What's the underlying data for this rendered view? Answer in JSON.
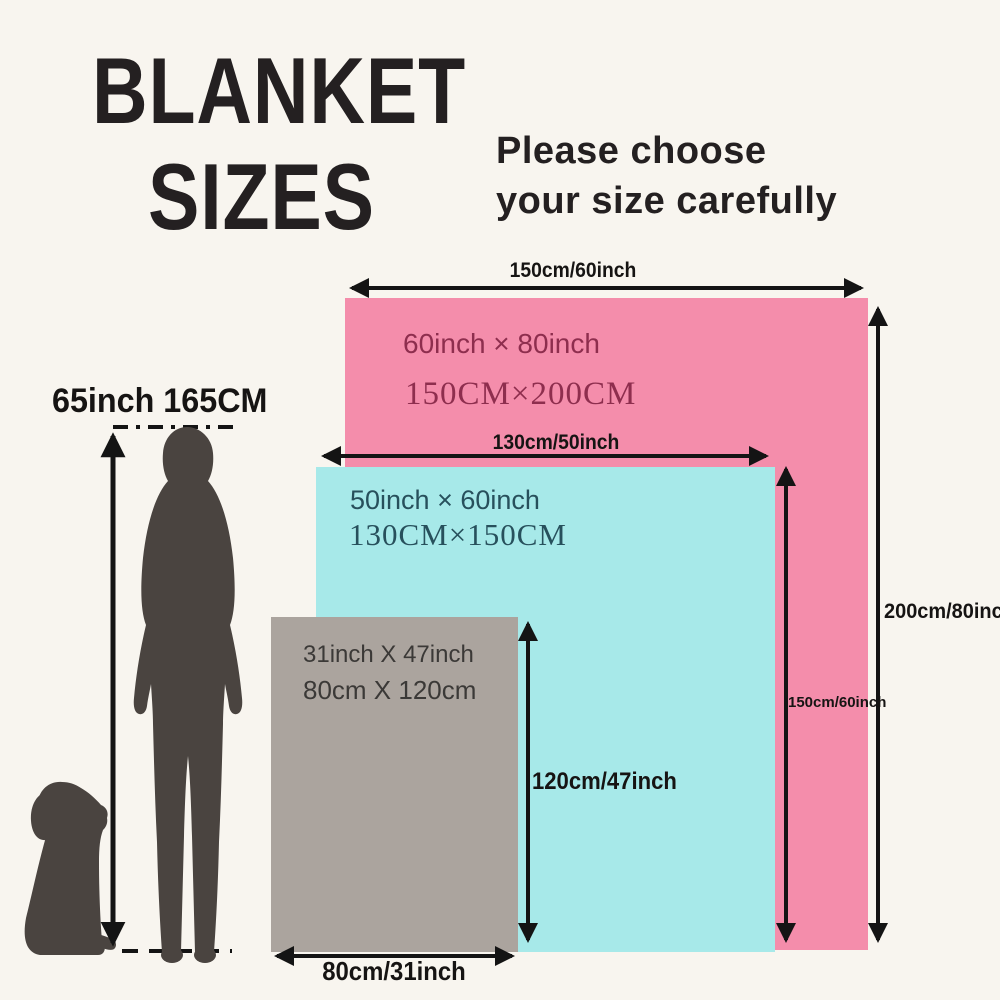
{
  "page": {
    "background": "#f8f5ef",
    "ink_color": "#141414"
  },
  "title": {
    "line1": "BLANKET",
    "line2": "SIZES"
  },
  "subtitle": {
    "line1": "Please choose",
    "line2": "your size carefully"
  },
  "person": {
    "height_label": "65inch 165CM",
    "silhouette_color": "#4a4440"
  },
  "blankets": {
    "large": {
      "fill": "#f48dab",
      "text_color": "#8e2e4e",
      "size_inch": "60inch × 80inch",
      "size_cm": "150CM×200CM",
      "width_label": "150cm/60inch",
      "height_label": "200cm/80inch"
    },
    "medium": {
      "fill": "#a7e9e9",
      "text_color": "#27505c",
      "size_inch": "50inch × 60inch",
      "size_cm": "130CM×150CM",
      "width_label": "130cm/50inch",
      "height_label": "150cm/60inch"
    },
    "small": {
      "fill": "#aba49e",
      "text_color": "#3b3937",
      "size_inch": "31inch X 47inch",
      "size_cm": "80cm X 120cm",
      "width_label": "80cm/31inch",
      "height_label": "120cm/47inch"
    }
  }
}
